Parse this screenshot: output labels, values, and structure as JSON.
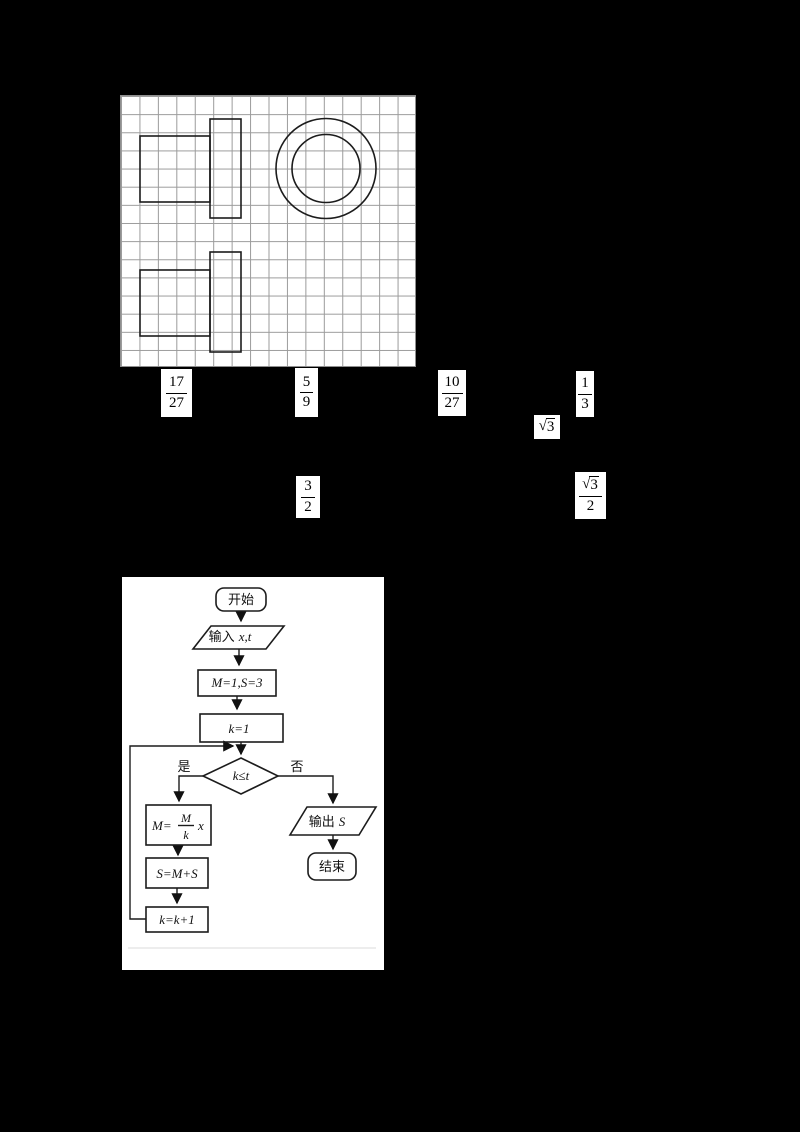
{
  "page": {
    "background": "#000000",
    "panel_background": "#ffffff",
    "grid_line_color": "#9b9b9b",
    "figure_line_color": "#1c1c1c"
  },
  "formulas": {
    "frac_17_27": {
      "num": "17",
      "den": "27"
    },
    "frac_5_9": {
      "num": "5",
      "den": "9"
    },
    "frac_10_27": {
      "num": "10",
      "den": "27"
    },
    "frac_1_3": {
      "num": "1",
      "den": "3"
    },
    "sqrt3": {
      "rad": "√",
      "radicand": "3"
    },
    "frac_3_2": {
      "num": "3",
      "den": "2"
    },
    "frac_sqrt3_2": {
      "num_rad": "√",
      "num_radicand": "3",
      "den": "2"
    }
  },
  "flowchart": {
    "start": "开始",
    "input_label": "输入",
    "input_vars": "x,t",
    "init": "M=1,S=3",
    "k_init": "k=1",
    "decision": "k≤t",
    "yes": "是",
    "no": "否",
    "update_m_prefix": "M=",
    "update_m_num": "M",
    "update_m_den": "k",
    "update_m_suffix": "x",
    "update_s": "S=M+S",
    "update_k": "k=k+1",
    "output_label": "输出",
    "output_var": "S",
    "end": "结束"
  }
}
